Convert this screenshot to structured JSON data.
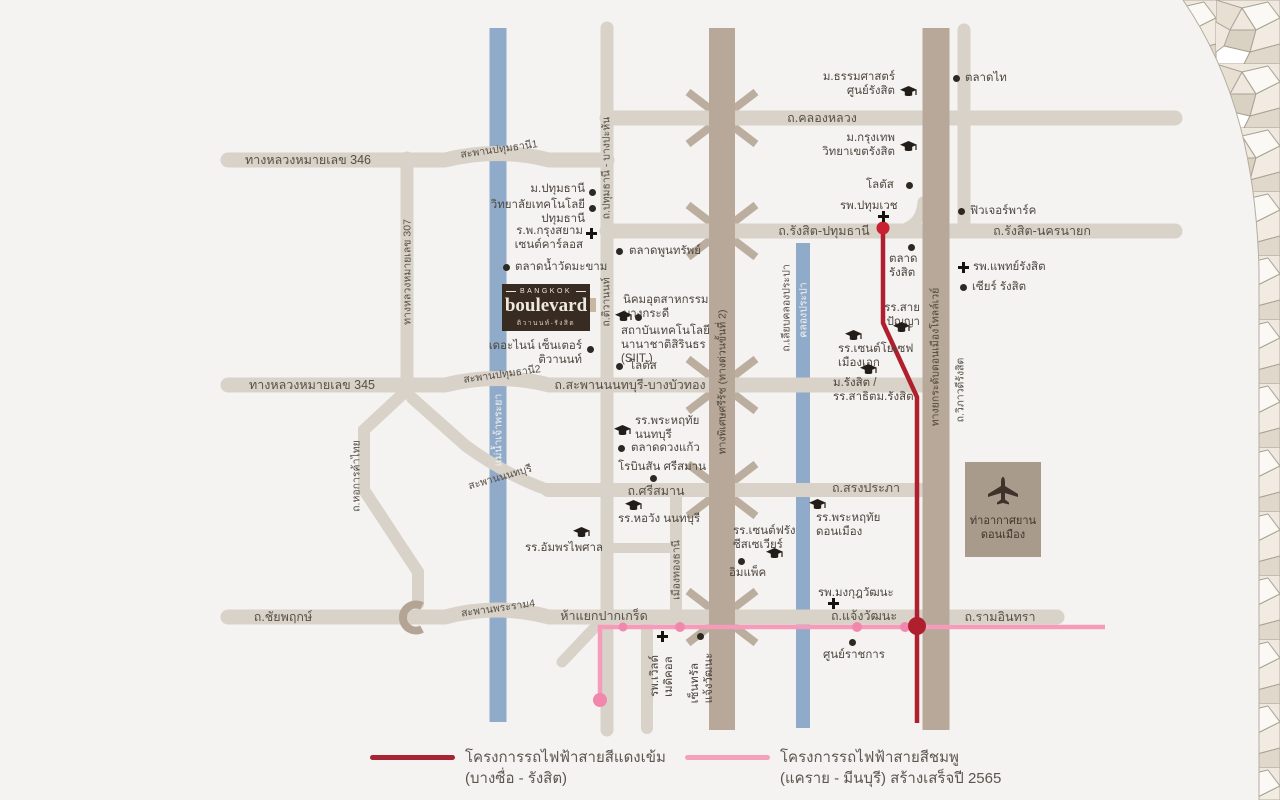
{
  "map": {
    "logo": {
      "brand_top": "BANGKOK",
      "brand": "boulevard",
      "subtitle": "ติวานนท์-รังสิต"
    },
    "airport": {
      "label": "ท่าอากาศยาน\nดอนเมือง"
    },
    "pois": {
      "thammasat": {
        "label": "ม.ธรรมศาสตร์\nศูนย์รังสิต"
      },
      "taladThai": {
        "label": "ตลาดไท"
      },
      "bangkokU": {
        "label": "ม.กรุงเทพ\nวิทยาเขตรังสิต"
      },
      "lotusRangsit": {
        "label": "โลตัส"
      },
      "pathumWet": {
        "label": "รพ.ปทุมเวช"
      },
      "futurePark": {
        "label": "ฟิวเจอร์พาร์ค"
      },
      "taladRangsit": {
        "label": "ตลาด\nรังสิต"
      },
      "medRangsit": {
        "label": "รพ.แพทย์รังสิต"
      },
      "zeerRangsit": {
        "label": "เซียร์ รังสิต"
      },
      "saiPanya": {
        "label": "รร.สาย\nปัญญา"
      },
      "stJoseph": {
        "label": "รร.เซนต์โยเซฟ\nเมืองเอก"
      },
      "rangsitU": {
        "label": "ม.รังสิต /\nรร.สาธิตม.รังสิต"
      },
      "pathumU": {
        "label": "ม.ปทุมธานี"
      },
      "pathumTech": {
        "label": "วิทยาลัยเทคโนโลยี\nปทุมธานี"
      },
      "stCarlos": {
        "label": "ร.พ.กรุงสยาม\nเซนต์คาร์ลอส"
      },
      "watMakham": {
        "label": "ตลาดน้ำวัดมะขาม"
      },
      "poonsap": {
        "label": "ตลาดพูนทรัพย์"
      },
      "bangkadi": {
        "label": "นิคมอุตสาหกรรม\nบางกระดี"
      },
      "siit": {
        "label": "สถาบันเทคโนโลยี\nนานาชาติสิรินธร\n(SIIT )"
      },
      "lotusTiwanon": {
        "label": "โลตัส"
      },
      "theNine": {
        "label": "เดอะไนน์ เซ็นเตอร์\nติวานนท์"
      },
      "praharuthaiNon": {
        "label": "รร.พระหฤทัย\nนนทบุรี"
      },
      "duangKaew": {
        "label": "ตลาดดวงแก้ว"
      },
      "robinson": {
        "label": "โรบินสัน ศรีสมาน"
      },
      "horwang": {
        "label": "รร.หอวัง นนทบุรี"
      },
      "amphon": {
        "label": "รร.อัมพรไพศาล"
      },
      "stFrancis": {
        "label": "รร.เซนต์ฟรัง\nซีสเซเวียร์"
      },
      "impact": {
        "label": "อิมแพ็ค"
      },
      "praharuthaiDon": {
        "label": "รร.พระหฤทัย\nดอนเมือง"
      },
      "mongkut": {
        "label": "รพ.มงกุฎวัฒนะ"
      },
      "rachakan": {
        "label": "ศูนย์ราชการ"
      },
      "worldMedical": {
        "label": "รพ.เวิลด์\nเมดิคอล"
      },
      "centralCW": {
        "label": "เซ็นทรัล\nแจ้งวัฒนะ"
      }
    },
    "roads": {
      "khlongLuang": {
        "label": "ถ.คลองหลวง"
      },
      "hw346": {
        "label": "ทางหลวงหมายเลข 346"
      },
      "hw307": {
        "label": "ทางหลวงหมายเลข 307"
      },
      "hw345": {
        "label": "ทางหลวงหมายเลข 345"
      },
      "rangsitPathum": {
        "label": "ถ.รังสิต-ปทุมธานี"
      },
      "rangsitNakhon": {
        "label": "ถ.รังสิต-นครนายก"
      },
      "pathumBangPahan": {
        "label": "ถ.ปทุมธานี - บางปะหัน"
      },
      "tiwanon": {
        "label": "ถ.ติวานนท์"
      },
      "sapanNonBang": {
        "label": "ถ.สะพานนนทบุรี-บางบัวทอง"
      },
      "srisaman": {
        "label": "ถ.ศรีสมาน"
      },
      "songprapha": {
        "label": "ถ.สรงประภา"
      },
      "chaiyaphruek": {
        "label": "ถ.ชัยพฤกษ์"
      },
      "chaengwattana": {
        "label": "ถ.แจ้งวัฒนะ"
      },
      "ramindra": {
        "label": "ถ.รามอินทรา"
      },
      "pakkret": {
        "label": "ห้าแยกปากเกร็ด"
      },
      "hokankha": {
        "label": "ถ.หอการค้าไทย"
      },
      "muangthong": {
        "label": "เมืองทองธานี"
      },
      "liabklong": {
        "label": "ถ.เลียบคลองประปา"
      },
      "expressway": {
        "label": "ทางพิเศษศรีรัช (ทางด่วนขั้นที่ 2)"
      },
      "tollway": {
        "label": "ทางยกระดับดอนเมืองโทลล์เวย์"
      },
      "wiphawadi": {
        "label": "ถ.วิภาวดีรังสิต"
      }
    },
    "bridges": {
      "pathum1": {
        "label": "สะพานปทุมธานี1"
      },
      "pathum2": {
        "label": "สะพานปทุมธานี2"
      },
      "nonthaburi": {
        "label": "สะพานนนทบุรี"
      },
      "rama4": {
        "label": "สะพานพระราม4"
      }
    },
    "waterways": {
      "chaophraya": {
        "label": "แม่น้ำเจ้าพระยา"
      },
      "prapa": {
        "label": "คลองประปา"
      }
    },
    "legend": {
      "red": {
        "title": "โครงการรถไฟฟ้าสายสีแดงเข้ม",
        "subtitle": "(บางซื่อ - รังสิต)",
        "color": "#a62433"
      },
      "pink": {
        "title": "โครงการรถไฟฟ้าสายสีชมพู",
        "subtitle": "(แคราย - มีนบุรี) สร้างเสร็จปี 2565",
        "color": "#f4a2ba"
      }
    },
    "colors": {
      "background": "#f4f3f1",
      "road": "#d8d2c8",
      "expressway": "#b7a899",
      "water": "#90abc9",
      "red_line": "#b01f2e",
      "pink_line": "#f59cba",
      "logo_bg": "#382b21",
      "airport_bg": "#a89b8c"
    }
  }
}
